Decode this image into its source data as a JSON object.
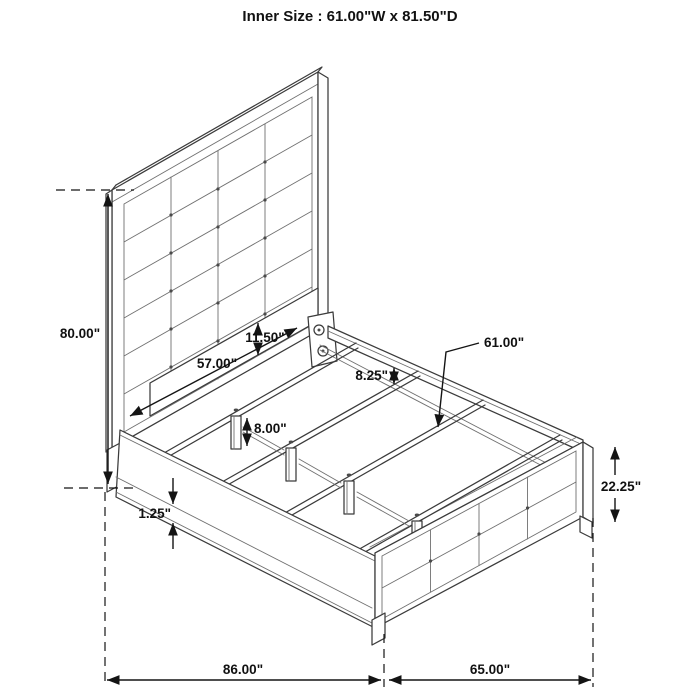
{
  "title": "Inner Size : 61.00\"W x 81.50\"D",
  "dimensions": {
    "headboard_height": "80.00\"",
    "headboard_rail_length": "57.00\"",
    "headboard_rail_height": "11.50\"",
    "rail_to_support_height": "8.25\"",
    "slat_length": "61.00\"",
    "center_leg_height": "8.00\"",
    "side_rail_trim": "1.25\"",
    "footboard_height": "22.25\"",
    "overall_length": "86.00\"",
    "footboard_width": "65.00\""
  }
}
